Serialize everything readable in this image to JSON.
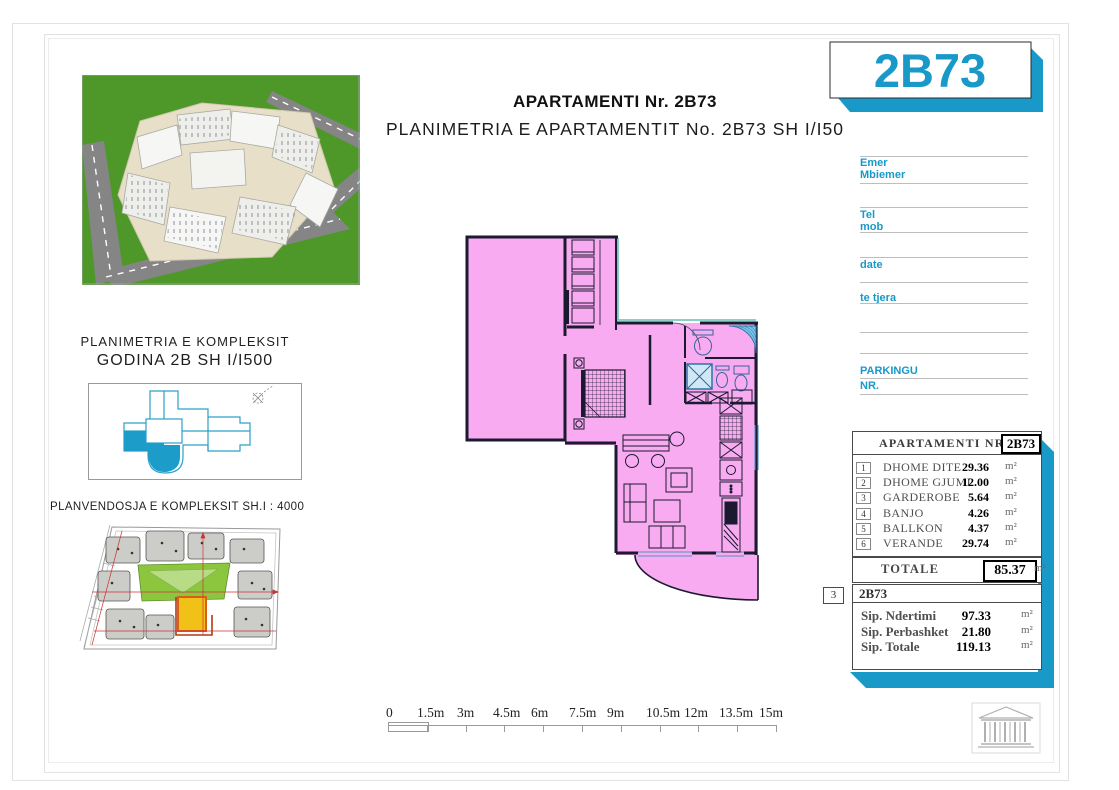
{
  "header": {
    "title": "APARTAMENTI Nr. 2B73",
    "subtitle": "PLANIMETRIA E APARTAMENTIT No. 2B73 SH I/I50",
    "unit_badge": "2B73"
  },
  "left_panel": {
    "complex_plan_title_line1": "PLANIMETRIA E KOMPLEKSIT",
    "complex_plan_title_line2": "GODINA 2B SH I/I500",
    "site_plan_caption": "PLANVENDOSJA E KOMPLEKSIT SH.I : 4000"
  },
  "contact_form": {
    "name_label": "Emer",
    "surname_label": "Mbiemer",
    "tel_label": "Tel",
    "mob_label": "mob",
    "date_label": "date",
    "other_label": "te tjera",
    "parking_label": "PARKINGU",
    "parking_nr_label": "NR."
  },
  "apartment_table": {
    "header_label": "APARTAMENTI  NR.",
    "header_unit": "2B73",
    "rows": [
      {
        "no": "1",
        "name": "DHOME DITE",
        "area": "29.36",
        "unit": "m²"
      },
      {
        "no": "2",
        "name": "DHOME GJUMI",
        "area": "12.00",
        "unit": "m²"
      },
      {
        "no": "3",
        "name": "GARDEROBE",
        "area": "5.64",
        "unit": "m²"
      },
      {
        "no": "4",
        "name": "BANJO",
        "area": "4.26",
        "unit": "m²"
      },
      {
        "no": "5",
        "name": "BALLKON",
        "area": "4.37",
        "unit": "m²"
      },
      {
        "no": "6",
        "name": "VERANDE",
        "area": "29.74",
        "unit": "m²"
      }
    ],
    "total_label": "TOTALE",
    "total_area": "85.37",
    "total_unit": "m²"
  },
  "summary_table": {
    "ref_no": "3",
    "title": "2B73",
    "rows": [
      {
        "name": "Sip. Ndertimi",
        "area": "97.33",
        "unit": "m²"
      },
      {
        "name": "Sip. Perbashket",
        "area": "21.80",
        "unit": "m²"
      },
      {
        "name": "Sip. Totale",
        "area": "119.13",
        "unit": "m²"
      }
    ]
  },
  "scale_bar": {
    "labels": [
      "0",
      "1.5m",
      "3m",
      "4.5m",
      "6m",
      "7.5m",
      "9m",
      "10.5m",
      "12m",
      "13.5m",
      "15m"
    ]
  },
  "colors": {
    "accent_cyan": "#1899c8",
    "plan_pink": "#f8abf0",
    "wall_dark": "#1a1a30",
    "fixture_blue": "#7fc4e8",
    "teal_line": "#63c1b4",
    "grass_green": "#4e9729",
    "highlight_yellow": "#f2c118",
    "site_red": "#cc3333"
  }
}
